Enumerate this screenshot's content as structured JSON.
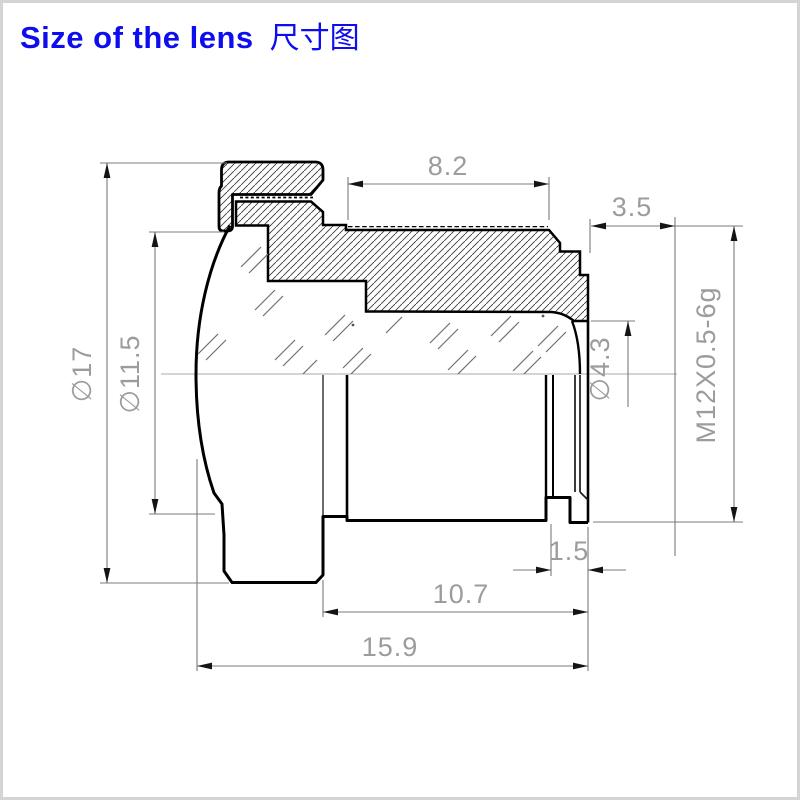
{
  "title": {
    "en": "Size of the lens",
    "cn": "尺寸图"
  },
  "colors": {
    "title_blue": "#0d0df0",
    "outline": "#000000",
    "dim_line": "#7b7b7b",
    "dim_text": "#9c9c9c",
    "arrow": "#141414",
    "centerline": "#a8a8a8",
    "page_border": "#d4d4d4",
    "background": "#ffffff"
  },
  "drawing": {
    "type": "technical half-section drawing of an M12 board lens",
    "dimensions": [
      {
        "label": "8.2",
        "value": 8.2,
        "orientation": "horizontal"
      },
      {
        "label": "3.5",
        "value": 3.5,
        "orientation": "horizontal"
      },
      {
        "label": "∅17",
        "value": 17,
        "orientation": "vertical"
      },
      {
        "label": "∅11.5",
        "value": 11.5,
        "orientation": "vertical"
      },
      {
        "label": "∅4.3",
        "value": 4.3,
        "orientation": "vertical"
      },
      {
        "label": "M12X0.5-6g",
        "orientation": "vertical"
      },
      {
        "label": "1.5",
        "value": 1.5,
        "orientation": "horizontal"
      },
      {
        "label": "10.7",
        "value": 10.7,
        "orientation": "horizontal"
      },
      {
        "label": "15.9",
        "value": 15.9,
        "orientation": "horizontal"
      }
    ]
  }
}
